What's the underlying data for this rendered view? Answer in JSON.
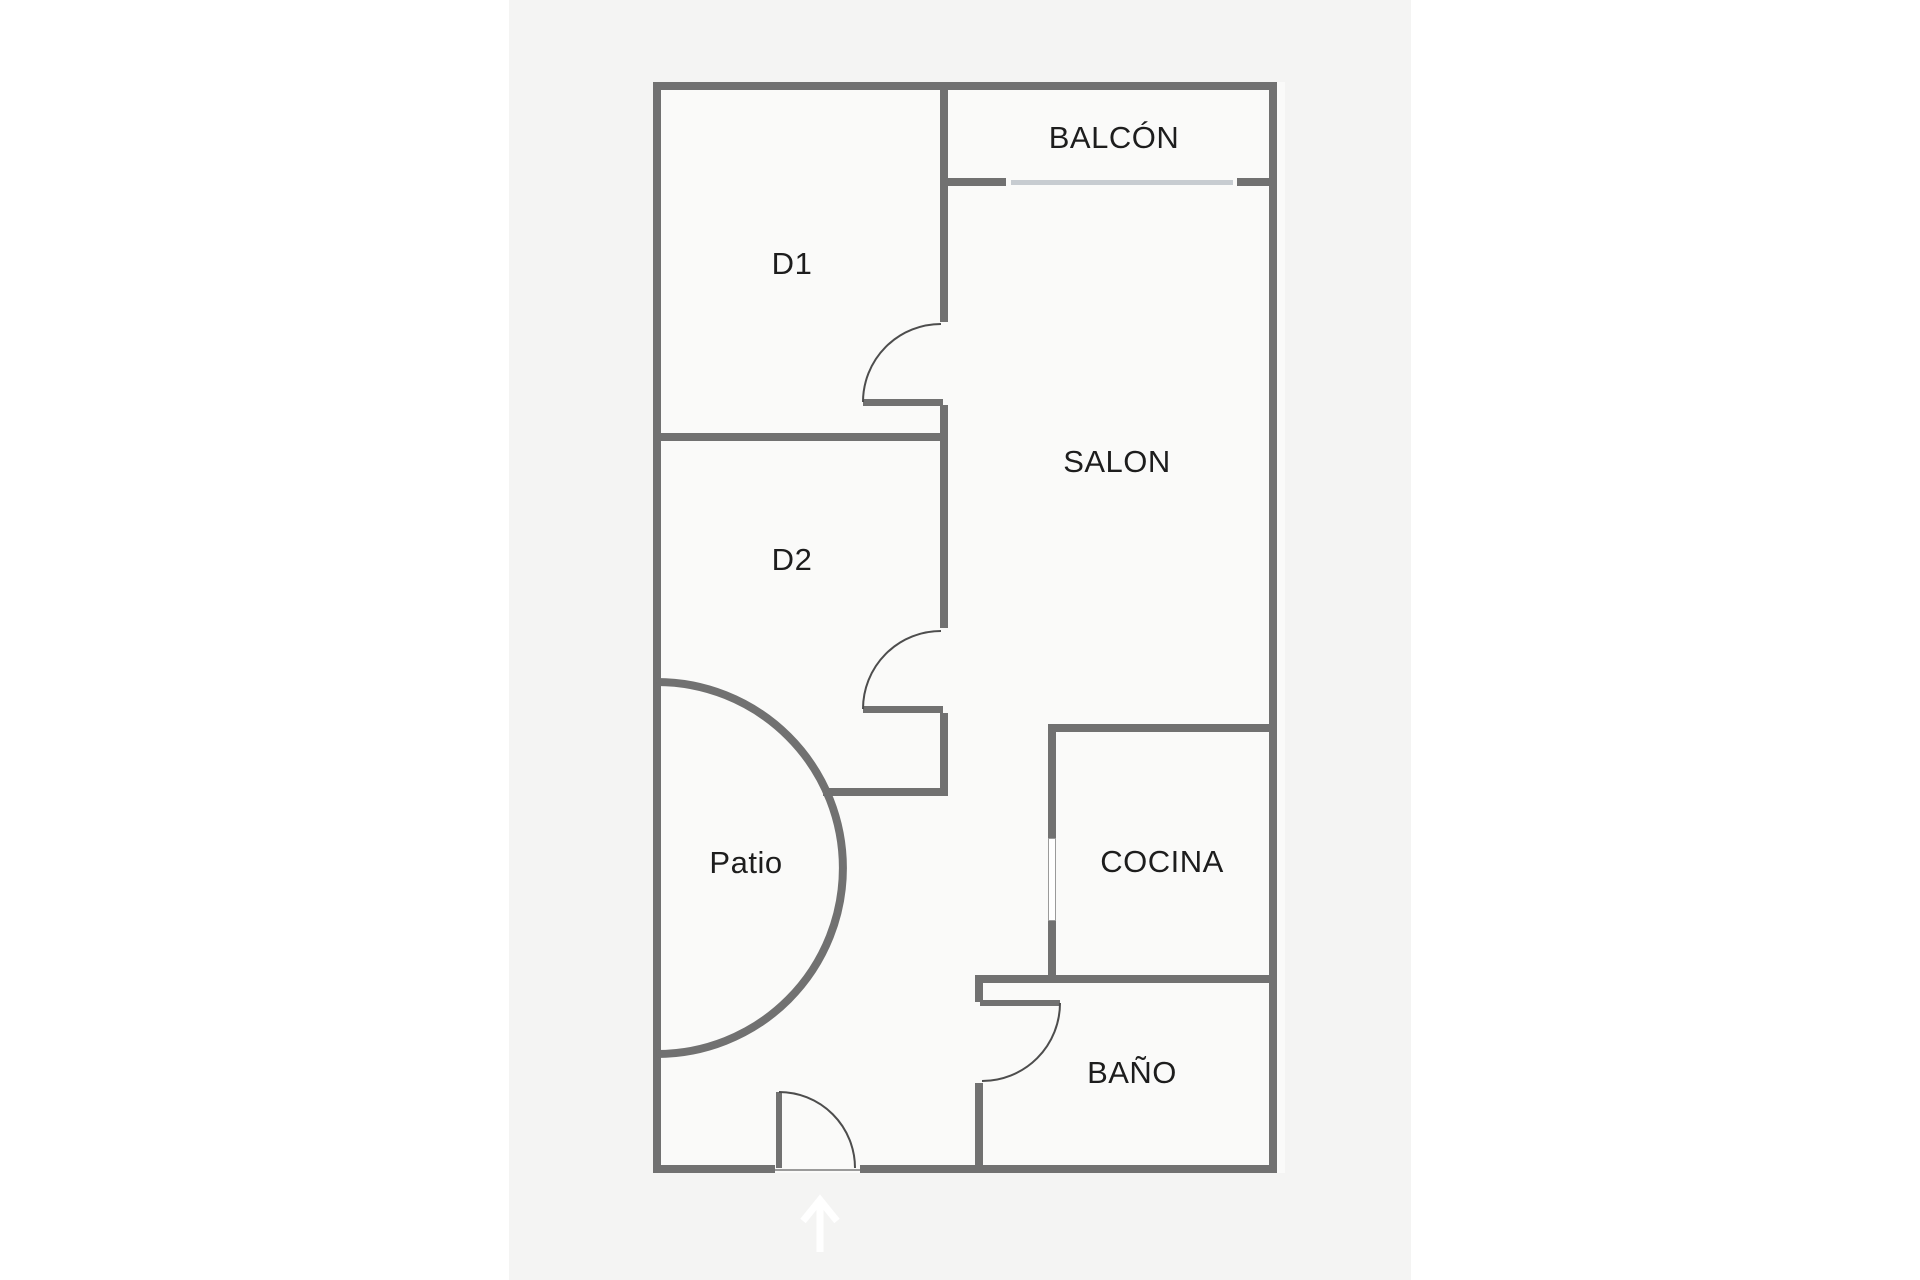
{
  "floorplan": {
    "title": "apartment-floor-plan",
    "rooms": [
      {
        "id": "balcon",
        "label": "BALCÓN"
      },
      {
        "id": "d1",
        "label": "D1"
      },
      {
        "id": "salon",
        "label": "SALON"
      },
      {
        "id": "d2",
        "label": "D2"
      },
      {
        "id": "patio",
        "label": "Patio"
      },
      {
        "id": "cocina",
        "label": "COCINA"
      },
      {
        "id": "bano",
        "label": "BAÑO"
      }
    ],
    "colors": {
      "wall": "#717171",
      "window": "#c7ccd1",
      "door_arc": "#4d4d4d",
      "text": "#1d1d1d",
      "canvas": "#f4f4f3",
      "room_fill": "#fafaf9",
      "page_margin": "#ffffff",
      "entrance_arrow": "#ffffff"
    },
    "icons": [
      {
        "name": "entrance-arrow-icon",
        "meaning": "entrance direction, pointing up into the flat"
      }
    ]
  }
}
